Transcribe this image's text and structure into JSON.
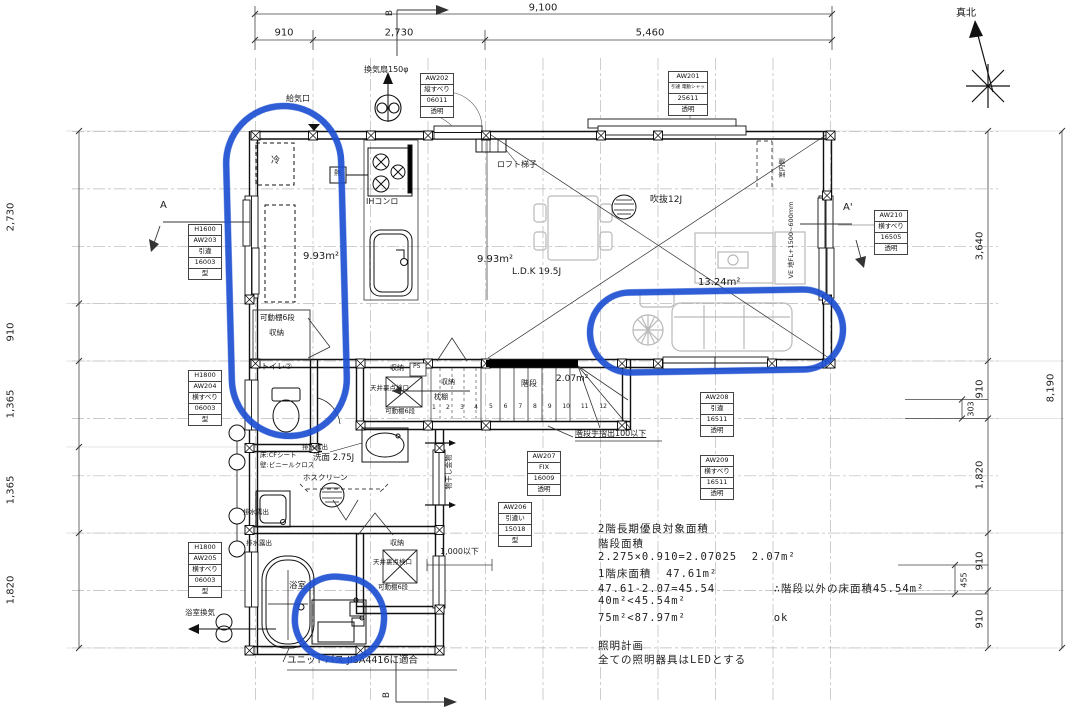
{
  "colors": {
    "annotation_blue": "#1d4fd2",
    "line_black": "#1a1a1a",
    "furniture_gray": "#b9b9b9"
  },
  "labels": {
    "north": "真北",
    "dim_total_top": "9,100",
    "dim_top_1": "910",
    "dim_top_2": "2,730",
    "dim_top_3": "5,460",
    "dim_left_1": "2,730",
    "dim_left_2": "910",
    "dim_left_3": "1,365",
    "dim_left_4": "1,365",
    "dim_left_5": "1,820",
    "dim_right_1": "3,640",
    "dim_right_2": "910",
    "dim_right_3": "1,820",
    "dim_right_4": "910",
    "dim_right_5": "910",
    "dim_right_total": "8,190",
    "dim_off_303": "303",
    "dim_off_455": "455",
    "sec_a": "A",
    "sec_a2": "A'",
    "sec_b_top": "B",
    "sec_b_bottom": "B",
    "range_hood": "換気扇150φ",
    "air_inlet": "給気口",
    "fridge": "冷",
    "heat": "熱",
    "ih": "IHコンロ",
    "loft": "ロフト梯子",
    "void12": "吹抜12J",
    "area_k": "9.93m²",
    "area_ldk": "9.93m²",
    "ldk": "L.D.K 19.5J",
    "area_living": "13.24m²",
    "shelf6": "可動棚6段",
    "storage": "収納",
    "toilet2": "トイレ②",
    "closet1_name": "収納",
    "ps": "PS",
    "closet1_hatch": "天井裏点検口",
    "closet1_shelf": "可動棚6段",
    "closet2_name": "収納",
    "closet2_shelf": "枕棚",
    "stair": "階段",
    "stair_area": "2.07m²",
    "handrail": "階段手摺出100以下",
    "drain1": "排水露出",
    "drain2": "排水露出",
    "drain3": "排水露出",
    "washroom": "洗面 2.75J",
    "floor_finish": "床:CFシート",
    "wall_finish": "壁:ビニールクロス",
    "hoscreen": "ホスクリーン",
    "bath": "浴室",
    "bath_vent": "浴室換気",
    "unit_bath": "ユニットバス JISA4416に適合",
    "closet3_name": "収納",
    "closet3_hatch": "天井裏点検口",
    "closet3_shelf": "可動棚6段",
    "under1000": "1,000以下",
    "laundry": "物干し金物",
    "interior_side": "室内側",
    "fl_note": "VE 地FL+1500~600mm"
  },
  "stairs": {
    "numbers": [
      "1",
      "2",
      "3",
      "4",
      "5",
      "6",
      "7",
      "8",
      "9",
      "10",
      "11",
      "12"
    ]
  },
  "window_tags": {
    "aw201": [
      "AW201",
      "引違 電動シャッター付",
      "25611",
      "透明"
    ],
    "aw202": [
      "AW202",
      "縦すべり",
      "06011",
      "透明"
    ],
    "aw203": [
      "H1600",
      "AW203",
      "引違",
      "16003",
      "型"
    ],
    "aw204": [
      "H1800",
      "AW204",
      "横すべり",
      "06003",
      "型"
    ],
    "aw205": [
      "H1800",
      "AW205",
      "横すべり",
      "06003",
      "型"
    ],
    "aw206": [
      "AW206",
      "引違い",
      "15018",
      "型"
    ],
    "aw207": [
      "AW207",
      "FIX",
      "16009",
      "透明"
    ],
    "aw208": [
      "AW208",
      "引違",
      "16511",
      "透明"
    ],
    "aw209": [
      "AW209",
      "横すべり",
      "16511",
      "透明"
    ],
    "aw210": [
      "AW210",
      "横すべり",
      "16505",
      "透明"
    ]
  },
  "notes": {
    "lines": [
      "2階長期優良対象面積",
      "階段面積",
      "2.275×0.910=2.07025  2.07m²",
      "1階床面積  47.61m²",
      "47.61-2.07=45.54        ∴階段以外の床面積45.54m²",
      "40m²<45.54m²",
      "75m²<87.97m²            ok",
      "照明計画",
      "全ての照明器具はLEDとする"
    ]
  }
}
